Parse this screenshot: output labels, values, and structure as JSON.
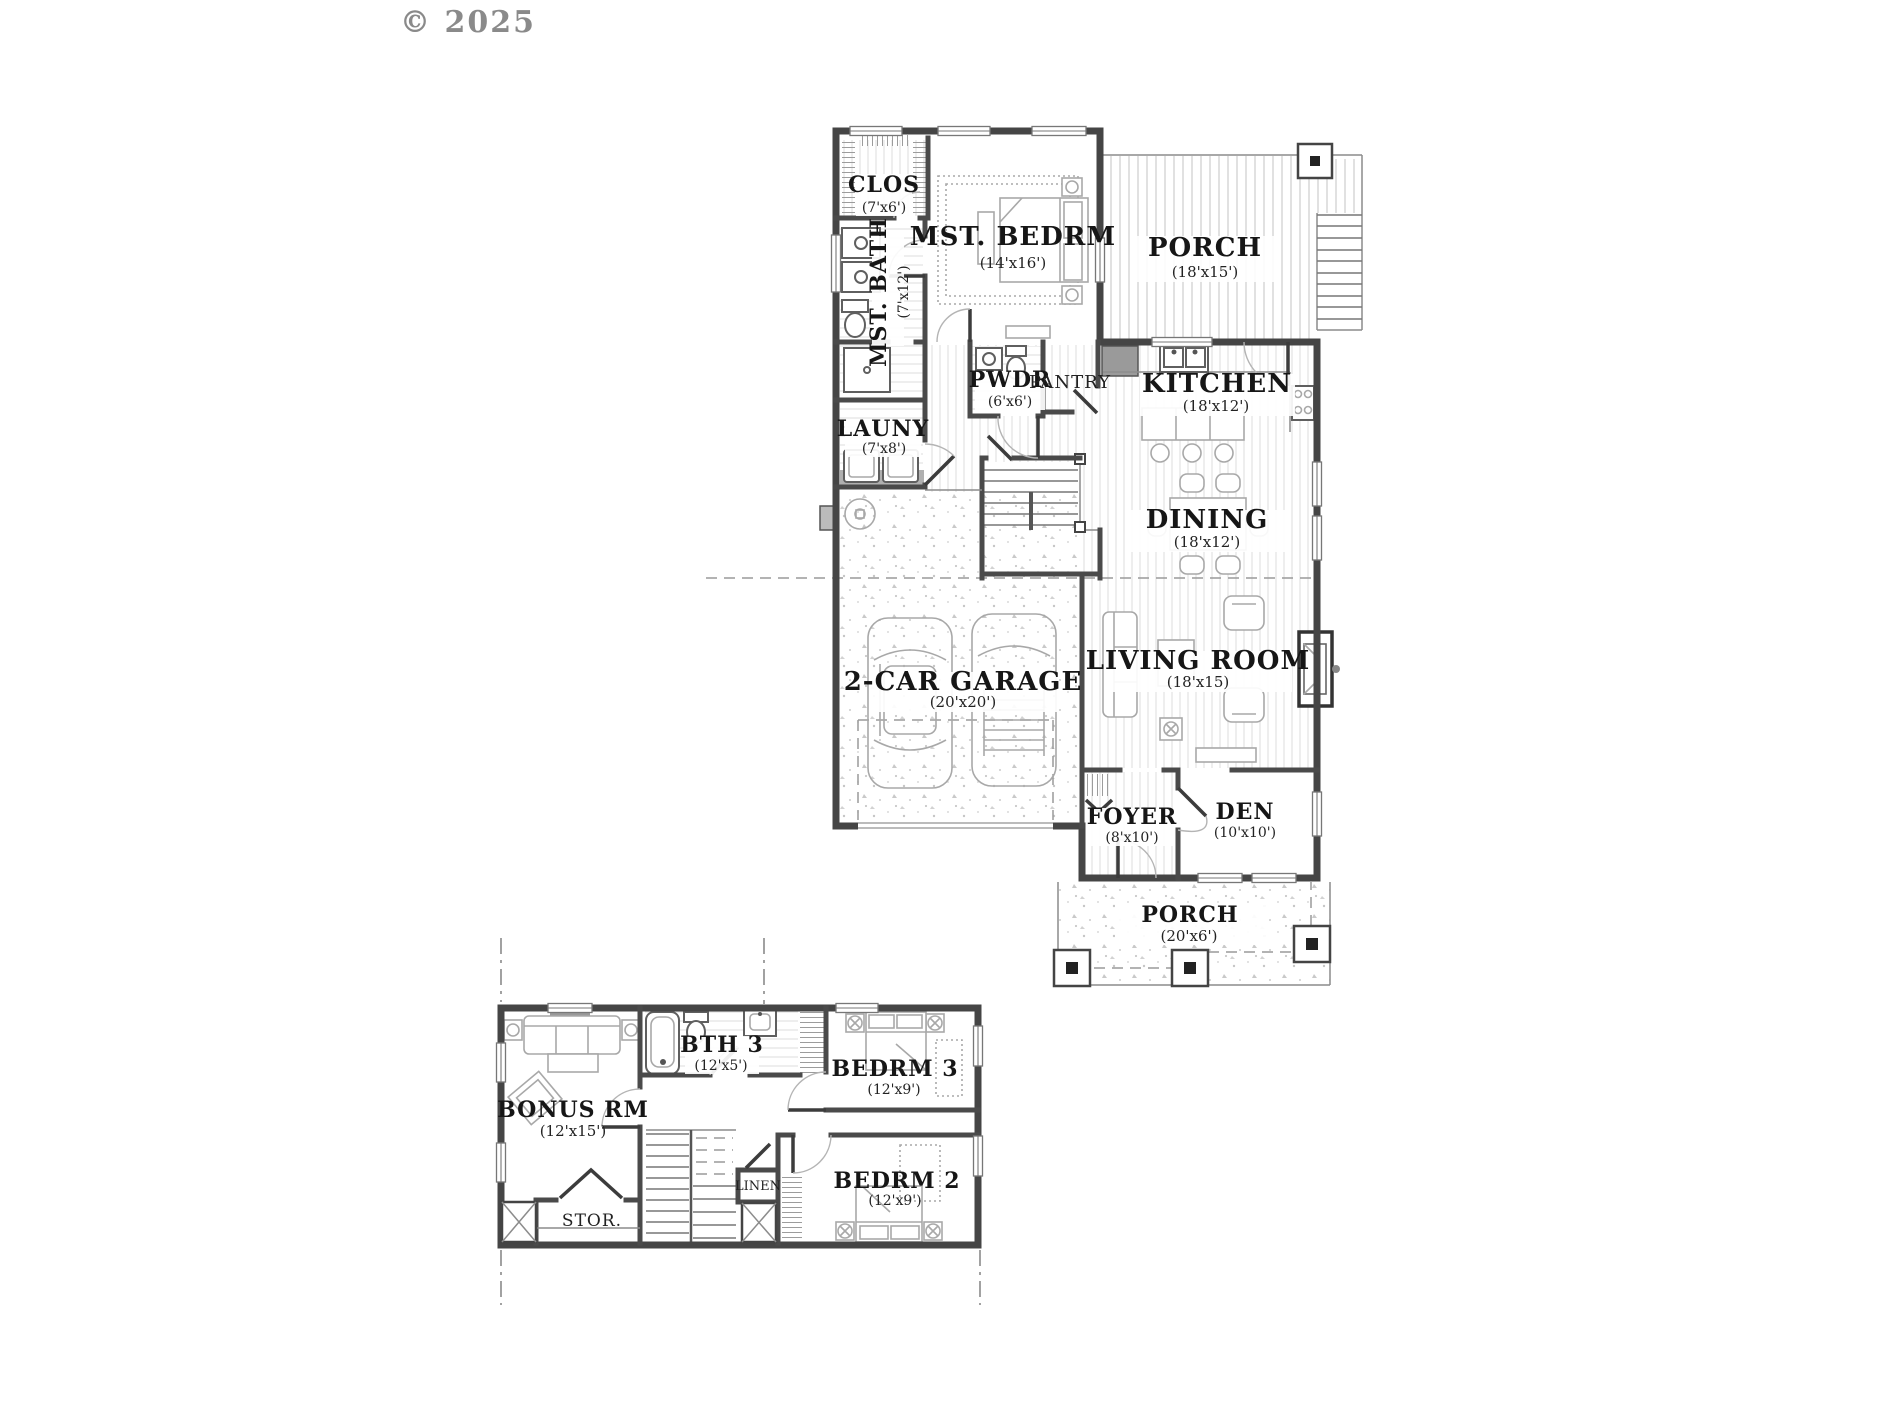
{
  "copyright": "© 2025",
  "main_floor": {
    "rooms": [
      {
        "name": "CLOS",
        "dims": "(7'x6')"
      },
      {
        "name": "MST. BATH",
        "dims": "(7'x12')"
      },
      {
        "name": "MST. BEDRM",
        "dims": "(14'x16')"
      },
      {
        "name": "PORCH",
        "dims": "(18'x15')"
      },
      {
        "name": "PWDR",
        "dims": "(6'x6')"
      },
      {
        "name": "PANTRY",
        "dims": ""
      },
      {
        "name": "KITCHEN",
        "dims": "(18'x12')"
      },
      {
        "name": "LAUNY",
        "dims": "(7'x8')"
      },
      {
        "name": "DINING",
        "dims": "(18'x12')"
      },
      {
        "name": "2-CAR GARAGE",
        "dims": "(20'x20')"
      },
      {
        "name": "LIVING ROOM",
        "dims": "(18'x15)"
      },
      {
        "name": "FOYER",
        "dims": "(8'x10')"
      },
      {
        "name": "DEN",
        "dims": "(10'x10')"
      },
      {
        "name": "PORCH",
        "dims": "(20'x6')"
      }
    ]
  },
  "upper_floor": {
    "rooms": [
      {
        "name": "BONUS RM",
        "dims": "(12'x15')"
      },
      {
        "name": "BTH 3",
        "dims": "(12'x5')"
      },
      {
        "name": "BEDRM 3",
        "dims": "(12'x9')"
      },
      {
        "name": "BEDRM 2",
        "dims": "(12'x9')"
      },
      {
        "name": "STOR.",
        "dims": ""
      },
      {
        "name": "LINEN",
        "dims": ""
      }
    ]
  }
}
